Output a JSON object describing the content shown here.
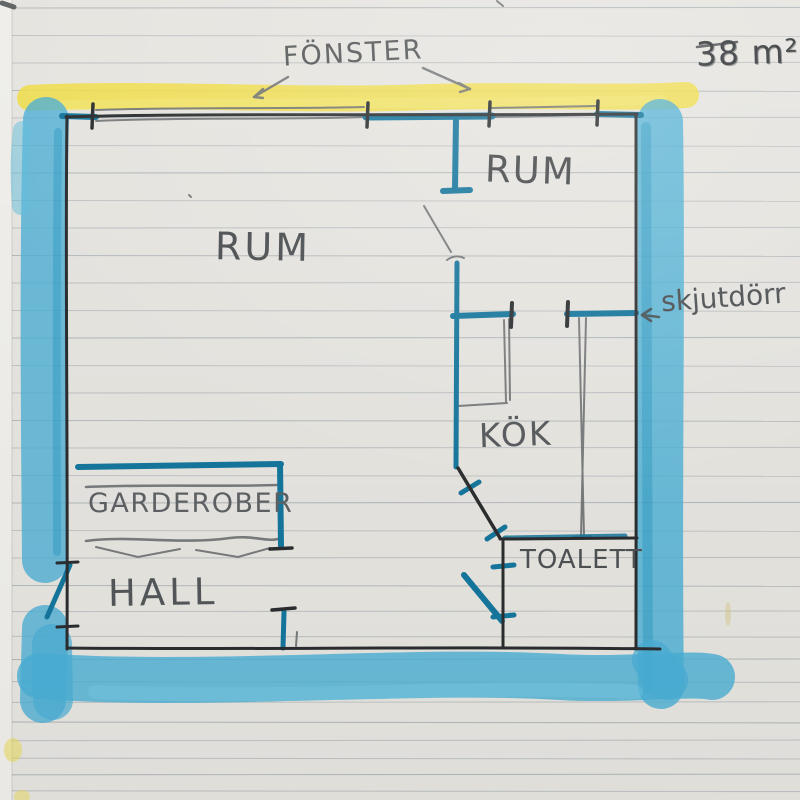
{
  "drawing": {
    "type": "hand-drawn floor plan on lined notebook paper",
    "area_label": "38 m²",
    "labels": {
      "window": "FÖNSTER",
      "room_main": "RUM",
      "room_second": "RUM",
      "sliding_door": "skjutdörr",
      "kitchen": "KÖK",
      "wardrobe": "GARDEROBER",
      "hall": "HALL",
      "toilet": "TOALETT"
    },
    "colors": {
      "paper": "#eae8e3",
      "ruled_line": "#99a3ab",
      "highlighter_yellow": "#f5e049",
      "marker_blue": "#4ab1d8",
      "pen_blue": "#16789f",
      "pen_black": "#2b2e30",
      "pencil": "#6e7173"
    }
  }
}
